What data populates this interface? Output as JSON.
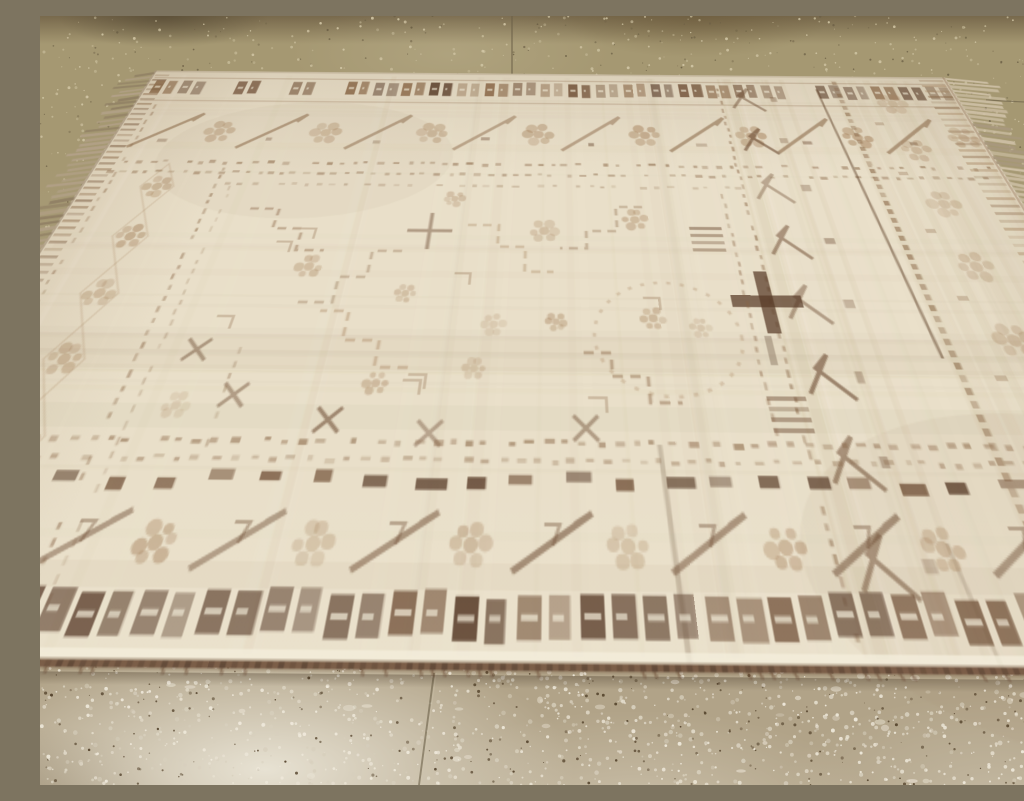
{
  "meta": {
    "title": "Worn antique cream handmade rug on a speckled concrete tile floor",
    "alt": "Photograph of a distressed antique ivory rug with faded brown geometric borders and motifs, knotted fringe on its sides and a dark brown selvage at the bottom edge, lying on olive-tan and light gray speckled concrete tiles",
    "media_type": "photograph"
  },
  "scene": {
    "floor": {
      "upper_region": "olive-tan speckled concrete tile with darker stains along the top edge",
      "lower_region": "lighter gray-beige speckled concrete tile with bright white patches",
      "tile_seams": 3
    },
    "rug": {
      "style": "distressed antique village rug, heavily faded low pile",
      "field": "ivory / cream",
      "pattern_color": "faded brown",
      "motifs": [
        "checkered square guard bands top and bottom",
        "chevron-and-rosette main borders",
        "zigzag hook motifs in wide right-hand border",
        "rosette column in left border",
        "stepped medallion outlines in field",
        "bold dark cross mark",
        "dotted guard lines",
        "bold broken dash row above bottom border"
      ],
      "edges": {
        "bottom": "dark brown overcast selvage",
        "left": "short knotted fringe",
        "right": "longer knotted fringe"
      }
    }
  },
  "palette": {
    "floor_top_shadow": "#78694c",
    "floor_top_base": "#a59872",
    "floor_bottom_base": "#b1a388",
    "floor_speckle_light_top": "#d2c7a6",
    "floor_speckle_dark_top": "#6b5f45",
    "floor_speckle_white": "#efe9db",
    "floor_speckle_mid": "#d7cfbd",
    "floor_speckle_dark": "#57462f",
    "seam": "#6b6048",
    "rug_base": "#e9dfc9",
    "rug_light": "#f3ecd9",
    "rug_shade": "#d7c8ac",
    "motif_faint": "#a8845f",
    "motif_mid": "#8a6747",
    "motif_dark": "#6b4930",
    "motif_bold": "#573a27",
    "selvage": "#6a4a34",
    "fringe_left": "#b3a189",
    "fringe_right": "#cfc1a7"
  },
  "texture": {
    "seed": 13,
    "floor_speckles_upper": 750,
    "floor_speckles_lower": 1350,
    "rug_streaks": 95,
    "scatter_rosettes": 12,
    "bold_dash_count": 30
  }
}
